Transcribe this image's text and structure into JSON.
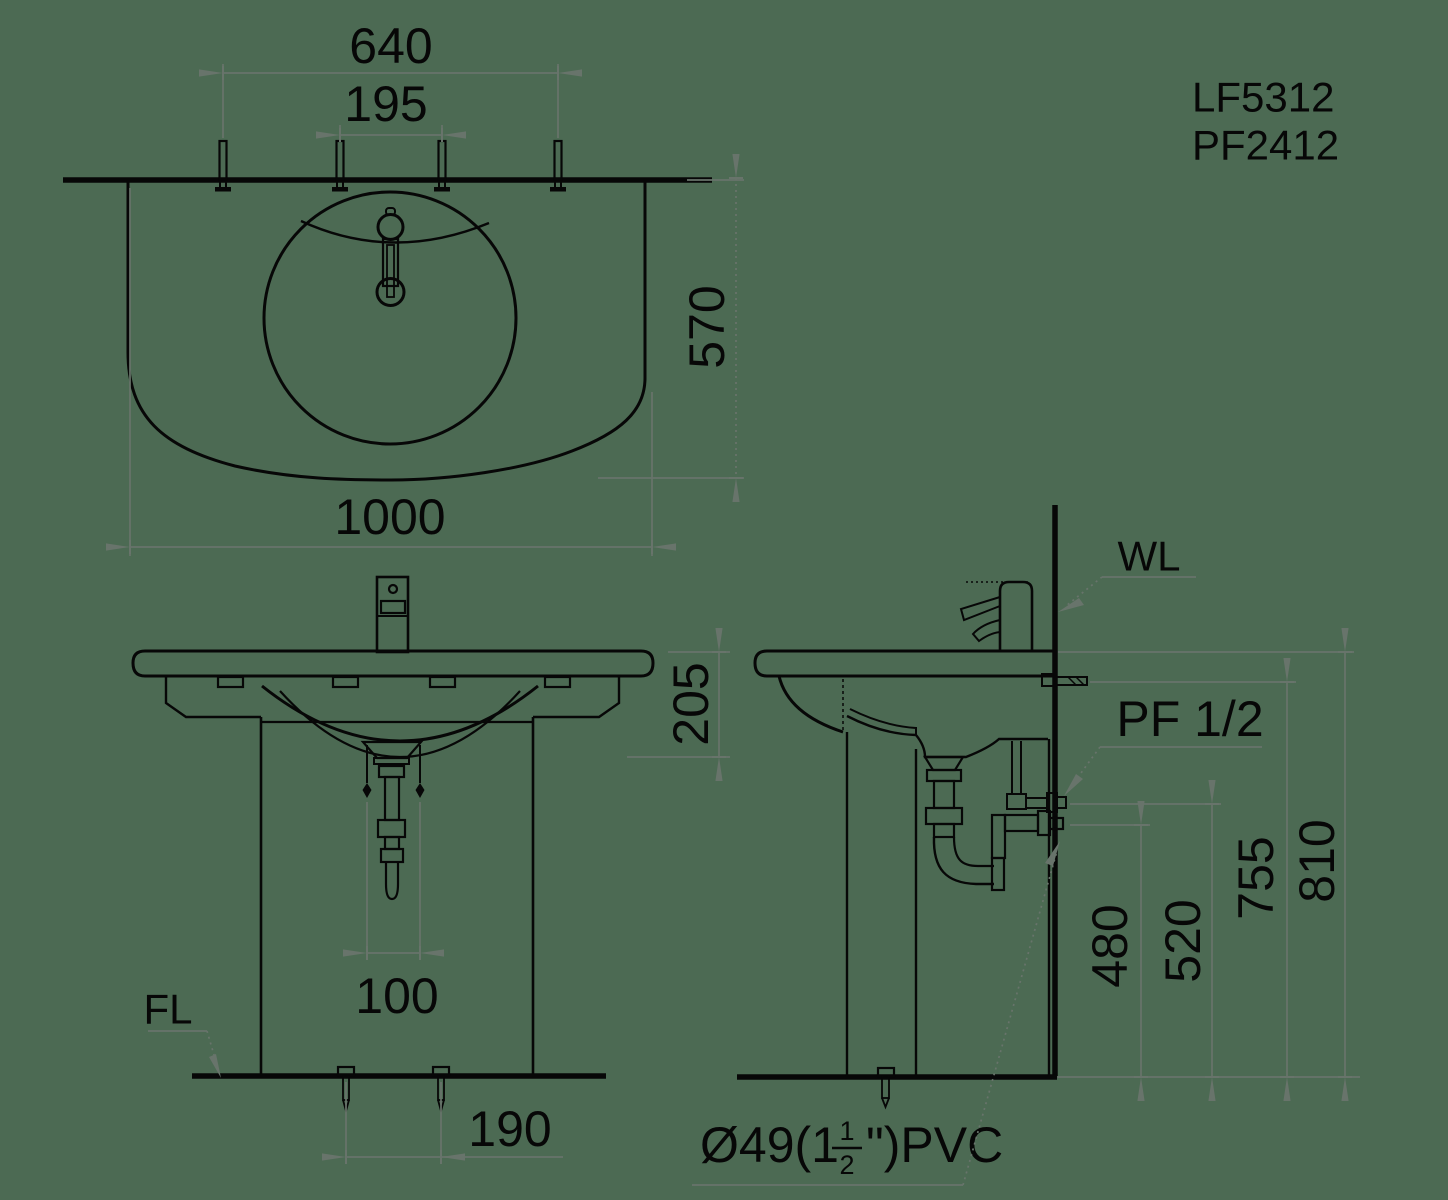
{
  "colors": {
    "background": "#4c6a53",
    "ink": "#070707",
    "dimension": "#68746b"
  },
  "models": {
    "line1": "LF5312",
    "line2": "PF2412"
  },
  "plan_view": {
    "dim_faucet_holes_outer": "640",
    "dim_faucet_holes_center": "195",
    "dim_depth": "570",
    "dim_width": "1000"
  },
  "front_view": {
    "dim_rim_to_trap": "205",
    "dim_drain_offset": "100",
    "dim_anchor_spacing": "190",
    "floor_line_label": "FL"
  },
  "side_view": {
    "wall_line_label": "WL",
    "supply_thread_label": "PF 1/2",
    "dim_drain_outlet_height": "480",
    "dim_supply_height": "520",
    "dim_bracket_height": "755",
    "dim_rim_height": "810",
    "drain_label": {
      "prefix": "Ø49(1",
      "numerator": "1",
      "denominator": "2",
      "suffix": "\")PVC"
    }
  }
}
